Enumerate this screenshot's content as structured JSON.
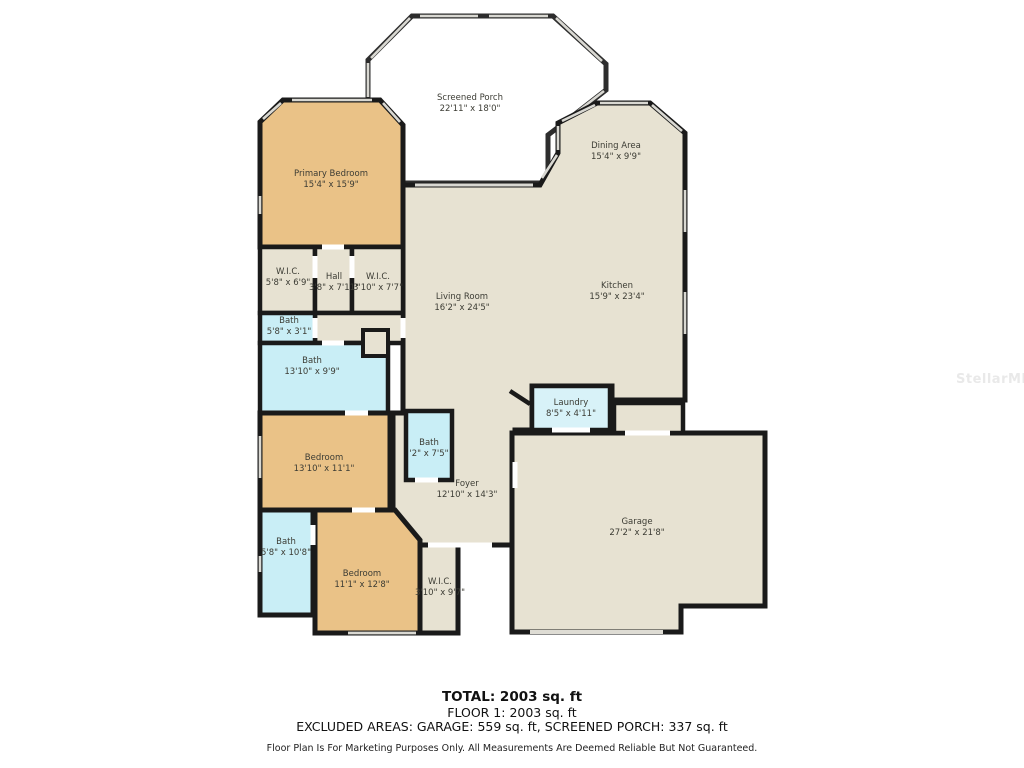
{
  "watermark": "StellarMLS",
  "rooms": [
    {
      "name": "Screened Porch",
      "dims": "22'11\" x 18'0\""
    },
    {
      "name": "Dining Area",
      "dims": "15'4\" x 9'9\""
    },
    {
      "name": "Primary Bedroom",
      "dims": "15'4\" x 15'9\""
    },
    {
      "name": "W.I.C.",
      "dims": "5'8\" x 6'9\""
    },
    {
      "name": "Hall",
      "dims": "3'8\" x 7'11\""
    },
    {
      "name": "W.I.C.",
      "dims": "3'10\" x 7'7\""
    },
    {
      "name": "Bath",
      "dims": "5'8\" x 3'1\""
    },
    {
      "name": "Bath",
      "dims": "13'10\" x 9'9\""
    },
    {
      "name": "Living Room",
      "dims": "16'2\" x 24'5\""
    },
    {
      "name": "Kitchen",
      "dims": "15'9\" x 23'4\""
    },
    {
      "name": "Laundry",
      "dims": "8'5\" x 4'11\""
    },
    {
      "name": "Bedroom",
      "dims": "13'10\" x 11'1\""
    },
    {
      "name": "Bath",
      "dims": "'2\" x 7'5\""
    },
    {
      "name": "Foyer",
      "dims": "12'10\" x 14'3\""
    },
    {
      "name": "Garage",
      "dims": "27'2\" x 21'8\""
    },
    {
      "name": "Bath",
      "dims": "5'8\" x 10'8\""
    },
    {
      "name": "Bedroom",
      "dims": "11'1\" x 12'8\""
    },
    {
      "name": "W.I.C.",
      "dims": "3'10\" x 9'7\""
    }
  ],
  "footer": {
    "total": "TOTAL: 2003 sq. ft",
    "floor": "FLOOR 1: 2003 sq. ft",
    "excluded": "EXCLUDED AREAS: GARAGE: 559 sq. ft, SCREENED PORCH: 337 sq. ft",
    "disclaimer": "Floor Plan Is For Marketing Purposes Only. All Measurements Are Deemed Reliable But Not Guaranteed."
  },
  "colors": {
    "bedroom_fill": "#EAC287",
    "living_fill": "#E7E2D2",
    "bath_fill": "#C9EEF6",
    "laundry_fill": "#D8F2F8",
    "wall": "#1A1A1A",
    "window": "#D9D8D2"
  }
}
